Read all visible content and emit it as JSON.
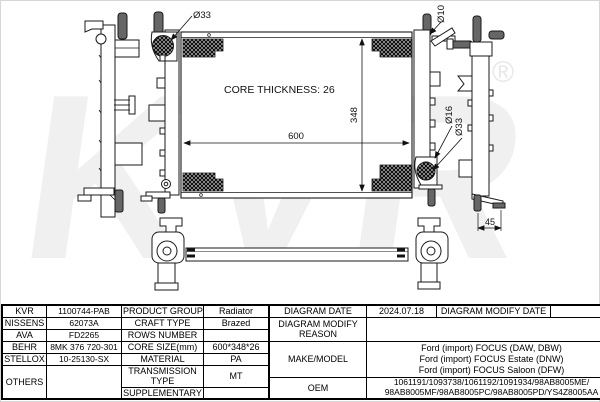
{
  "diagram": {
    "core_thickness_label": "CORE THICKNESS: 26",
    "dim_width": "600",
    "dim_height": "348",
    "dim_foot": "45",
    "port_top_left": "Ø33",
    "port_top_right": "Ø10",
    "port_right_16": "Ø16",
    "port_right_33": "Ø33",
    "watermark": "KVR",
    "watermark_reg": "®"
  },
  "table": {
    "left": {
      "rows": [
        {
          "brand": "KVR",
          "code": "1100744-PAB",
          "attr": "PRODUCT GROUP",
          "value": "Radiator"
        },
        {
          "brand": "NISSENS",
          "code": "62073A",
          "attr": "CRAFT TYPE",
          "value": "Brazed"
        },
        {
          "brand": "AVA",
          "code": "FD2265",
          "attr": "ROWS NUMBER",
          "value": ""
        },
        {
          "brand": "BEHR",
          "code": "8MK 376 720-301",
          "attr": "CORE SIZE(mm)",
          "value": "600*348*26"
        },
        {
          "brand": "STELLOX",
          "code": "10-25130-SX",
          "attr": "MATERIAL",
          "value": "PA"
        }
      ],
      "others_label": "OTHERS",
      "others_code": "",
      "transmission_label": "TRANSMISSION TYPE",
      "transmission_value": "MT",
      "supplementary_label": "SUPPLEMENTARY",
      "supplementary_value": ""
    },
    "right": {
      "diagram_date_label": "DIAGRAM DATE",
      "diagram_date": "2024.07.18",
      "modify_date_label": "DIAGRAM MODIFY DATE",
      "modify_date": "",
      "modify_reason_label": "DIAGRAM MODIFY REASON",
      "modify_reason": "",
      "make_model_label": "MAKE/MODEL",
      "make_model_lines": [
        "Ford (import) FOCUS (DAW, DBW)",
        "Ford (import) FOCUS Estate (DNW)",
        "Ford (import) FOCUS Saloon (DFW)"
      ],
      "oem_label": "OEM",
      "oem_lines": [
        "1061191/1093738/1061192/1091934/98AB8005ME/",
        "98AB8005MF/98AB8005PC/98AB8005PD/YS4Z8005AA"
      ]
    }
  }
}
